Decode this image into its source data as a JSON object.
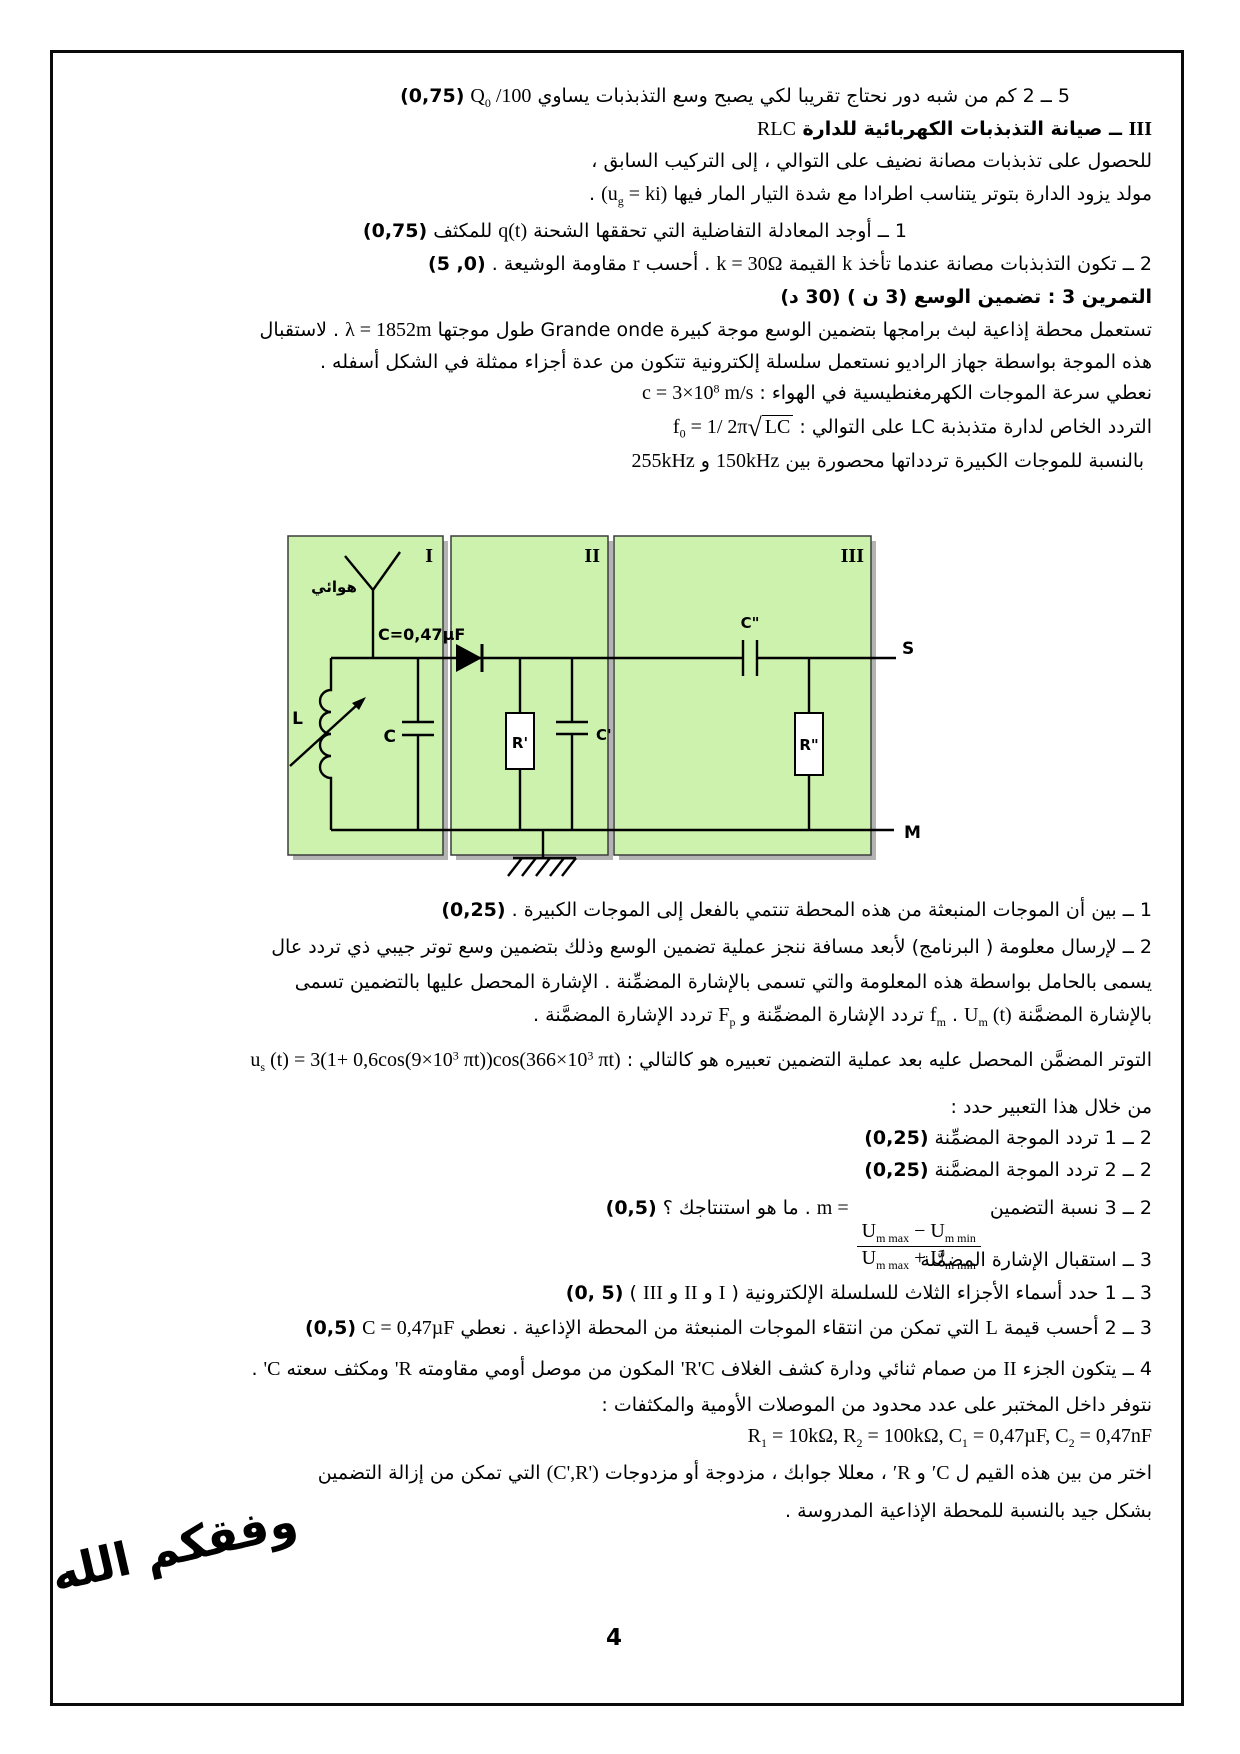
{
  "footer": {
    "dua": "وفقكم الله",
    "page_number": "4"
  },
  "colors": {
    "box_fill": "#ccf2ad",
    "box_stroke": "#3c3c3c",
    "box_shadow": "#b3b3b3",
    "ink": "#000000"
  },
  "diagram": {
    "box_labels": {
      "i": "I",
      "ii": "II",
      "iii": "III"
    },
    "antenna_label": "هوائي",
    "cap_value_label": "C=0,47µF",
    "inductor_label": "L",
    "cap_label": "C",
    "r_prime_label": "R'",
    "c_prime_label": "C'",
    "c_dprime_label": "C\"",
    "r_dprime_label": "R\"",
    "terminal_s": "S",
    "terminal_m": "M"
  },
  "lines": [
    {
      "top": 84,
      "r": 170,
      "segs": [
        {
          "k": "a",
          "t": "5 ــ 2 كم من شبه دور نحتاج تقريبا لكي يصبح وسع التذبذبات يساوي "
        },
        {
          "k": "f",
          "segs": [
            {
              "k": "m",
              "t": "Q"
            },
            {
              "k": "sub",
              "t": "0"
            },
            {
              "k": "m",
              "t": " /100"
            }
          ]
        },
        {
          "k": "a",
          "t": "  "
        },
        {
          "k": "b",
          "t": "(0,75)"
        }
      ]
    },
    {
      "top": 117,
      "r": 88,
      "segs": [
        {
          "k": "mb",
          "t": "III"
        },
        {
          "k": "ab",
          "t": " ــ صيانة التذبذبات الكهربائية للدارة "
        },
        {
          "k": "m",
          "t": "RLC"
        }
      ]
    },
    {
      "top": 150,
      "r": 88,
      "segs": [
        {
          "k": "a",
          "t": "للحصول على تذبذبات مصانة نضيف على التوالي ، إلى التركيب السابق ،"
        }
      ]
    },
    {
      "top": 182,
      "r": 88,
      "segs": [
        {
          "k": "a",
          "t": "مولد يزود الدارة بتوتر يتناسب اطرادا مع شدة التيار المار فيها "
        },
        {
          "k": "f",
          "segs": [
            {
              "k": "m",
              "t": "(u"
            },
            {
              "k": "sub",
              "t": "g"
            },
            {
              "k": "m",
              "t": " = ki)"
            }
          ]
        },
        {
          "k": "a",
          "t": " ."
        }
      ]
    },
    {
      "top": 219,
      "r": 333,
      "segs": [
        {
          "k": "a",
          "t": "1 ــ أوجد المعادلة التفاضلية التي تحققها الشحنة "
        },
        {
          "k": "f",
          "segs": [
            {
              "k": "m",
              "t": "q(t)"
            }
          ]
        },
        {
          "k": "a",
          "t": " للمكثف "
        },
        {
          "k": "b",
          "t": "(0,75)"
        }
      ]
    },
    {
      "top": 252,
      "r": 88,
      "segs": [
        {
          "k": "a",
          "t": "2 ــ تكون التذبذبات مصانة عندما تأخذ "
        },
        {
          "k": "m",
          "t": "k"
        },
        {
          "k": "a",
          "t": " القيمة "
        },
        {
          "k": "f",
          "segs": [
            {
              "k": "m",
              "t": "k = 30Ω"
            }
          ]
        },
        {
          "k": "a",
          "t": " . أحسب "
        },
        {
          "k": "m",
          "t": "r"
        },
        {
          "k": "a",
          "t": " مقاومة الوشيعة . "
        },
        {
          "k": "b",
          "t": "(0, 5)"
        }
      ]
    },
    {
      "top": 286,
      "r": 88,
      "segs": [
        {
          "k": "ab",
          "t": "التمرين 3 : تضمين الوسع (3 ن )  (30 د)"
        }
      ]
    },
    {
      "top": 318,
      "r": 88,
      "segs": [
        {
          "k": "a",
          "t": "تستعمل محطة إذاعية لبث برامجها بتضمين الوسع موجة كبيرة "
        },
        {
          "k": "a",
          "t": "Grande onde"
        },
        {
          "k": "a",
          "t": " طول موجتها "
        },
        {
          "k": "f",
          "segs": [
            {
              "k": "m",
              "t": "λ = 1852m"
            }
          ]
        },
        {
          "k": "a",
          "t": " . لاستقبال"
        }
      ]
    },
    {
      "top": 351,
      "r": 88,
      "segs": [
        {
          "k": "a",
          "t": "هذه الموجة بواسطة جهاز الراديو نستعمل سلسلة إلكترونية تتكون من عدة أجزاء ممثلة في الشكل أسفله ."
        }
      ]
    },
    {
      "top": 381,
      "r": 88,
      "segs": [
        {
          "k": "a",
          "t": "نعطي سرعة الموجات الكهرمغنطيسية في الهواء :  "
        },
        {
          "k": "f",
          "segs": [
            {
              "k": "m",
              "t": "c = 3×10"
            },
            {
              "k": "sup",
              "t": "8"
            },
            {
              "k": "m",
              "t": " m/s"
            }
          ]
        }
      ]
    },
    {
      "top": 412,
      "r": 88,
      "segs": [
        {
          "k": "a",
          "t": "التردد الخاص لدارة متذبذبة "
        },
        {
          "k": "a",
          "t": "LC"
        },
        {
          "k": "a",
          "t": " على التوالي :  "
        },
        {
          "k": "f",
          "segs": [
            {
              "k": "m",
              "t": "f"
            },
            {
              "k": "sub",
              "t": "0"
            },
            {
              "k": "m",
              "t": " = 1/ 2π"
            },
            {
              "k": "sqrt",
              "segs": [
                {
                  "k": "m",
                  "t": "LC"
                }
              ]
            }
          ]
        }
      ]
    },
    {
      "top": 449,
      "r": 96,
      "segs": [
        {
          "k": "a",
          "t": "بالنسبة للموجات الكبيرة تردداتها محصورة بين  "
        },
        {
          "k": "m",
          "t": "150kHz"
        },
        {
          "k": "a",
          "t": " و "
        },
        {
          "k": "m",
          "t": "255kHz"
        }
      ]
    },
    {
      "top": 899,
      "r": 88,
      "segs": [
        {
          "k": "a",
          "t": "1 ــ بين أن الموجات المنبعثة من هذه المحطة تنتمي بالفعل إلى الموجات الكبيرة . "
        },
        {
          "k": "b",
          "t": "(0,25)"
        }
      ]
    },
    {
      "top": 936,
      "r": 88,
      "segs": [
        {
          "k": "a",
          "t": "2 ــ لإرسال معلومة ( البرنامج) لأبعد مسافة ننجز عملية تضمين الوسع وذلك بتضمين وسع توتر جيبي ذي تردد عال"
        }
      ]
    },
    {
      "top": 971,
      "r": 88,
      "segs": [
        {
          "k": "a",
          "t": "يسمى بالحامل بواسطة هذه المعلومة والتي تسمى بالإشارة المضمِّنة . الإشارة المحصل عليها بالتضمين تسمى"
        }
      ]
    },
    {
      "top": 1003,
      "r": 88,
      "segs": [
        {
          "k": "a",
          "t": "بالإشارة المضمَّنة "
        },
        {
          "k": "f",
          "segs": [
            {
              "k": "m",
              "t": "U"
            },
            {
              "k": "sub",
              "t": "m"
            },
            {
              "k": "m",
              "t": " (t)"
            }
          ]
        },
        {
          "k": "a",
          "t": " . "
        },
        {
          "k": "f",
          "segs": [
            {
              "k": "m",
              "t": "f"
            },
            {
              "k": "sub",
              "t": "m"
            }
          ]
        },
        {
          "k": "a",
          "t": " تردد الإشارة المضمِّنة و "
        },
        {
          "k": "f",
          "segs": [
            {
              "k": "m",
              "t": "F"
            },
            {
              "k": "sub",
              "t": "p"
            }
          ]
        },
        {
          "k": "a",
          "t": " تردد الإشارة المضمَّنة ."
        }
      ]
    },
    {
      "top": 1048,
      "r": 88,
      "segs": [
        {
          "k": "a",
          "t": "التوتر المضمَّن المحصل عليه بعد عملية التضمين تعبيره هو كالتالي :  "
        },
        {
          "k": "f",
          "segs": [
            {
              "k": "m",
              "t": "u"
            },
            {
              "k": "sub",
              "t": "s"
            },
            {
              "k": "m",
              "t": " (t) = 3(1+ 0,6cos(9×10"
            },
            {
              "k": "sup",
              "t": "3"
            },
            {
              "k": "m",
              "t": " πt))cos(366×10"
            },
            {
              "k": "sup",
              "t": "3"
            },
            {
              "k": "m",
              "t": " πt)"
            }
          ]
        }
      ]
    },
    {
      "top": 1096,
      "r": 88,
      "segs": [
        {
          "k": "a",
          "t": "من خلال هذا التعبير حدد :"
        }
      ]
    },
    {
      "top": 1127,
      "r": 88,
      "segs": [
        {
          "k": "a",
          "t": "2 ــ 1 تردد الموجة المضمِّنة "
        },
        {
          "k": "b",
          "t": "(0,25)"
        }
      ]
    },
    {
      "top": 1159,
      "r": 88,
      "segs": [
        {
          "k": "a",
          "t": "2 ــ 2 تردد الموجة المضمَّنة "
        },
        {
          "k": "b",
          "t": "(0,25)"
        }
      ]
    },
    {
      "top": 1196,
      "r": 88,
      "segs": [
        {
          "k": "a",
          "t": "2 ــ 3 نسبة التضمين  "
        },
        {
          "k": "f",
          "segs": [
            {
              "k": "m",
              "t": "m = "
            },
            {
              "k": "frac",
              "num": [
                {
                  "k": "m",
                  "t": "U"
                },
                {
                  "k": "sub",
                  "t": "m max"
                },
                {
                  "k": "m",
                  "t": " − U"
                },
                {
                  "k": "sub",
                  "t": "m min"
                }
              ],
              "den": [
                {
                  "k": "m",
                  "t": "U"
                },
                {
                  "k": "sub",
                  "t": "m max"
                },
                {
                  "k": "m",
                  "t": " + U"
                },
                {
                  "k": "sub",
                  "t": "m min"
                }
              ]
            }
          ]
        },
        {
          "k": "a",
          "t": " . ما هو استنتاجك ؟ "
        },
        {
          "k": "b",
          "t": "(0,5)"
        }
      ]
    },
    {
      "top": 1249,
      "r": 88,
      "segs": [
        {
          "k": "a",
          "t": "3 ــ استقبال الإشارة المضمَّنة"
        }
      ]
    },
    {
      "top": 1281,
      "r": 88,
      "segs": [
        {
          "k": "a",
          "t": "3 ــ 1 حدد أسماء الأجزاء الثلاث للسلسلة الإلكترونية ( "
        },
        {
          "k": "m",
          "t": "I"
        },
        {
          "k": "a",
          "t": " و "
        },
        {
          "k": "m",
          "t": "II"
        },
        {
          "k": "a",
          "t": " و "
        },
        {
          "k": "m",
          "t": "III"
        },
        {
          "k": "a",
          "t": " ) "
        },
        {
          "k": "b",
          "t": "(0, 5)"
        }
      ]
    },
    {
      "top": 1316,
      "r": 88,
      "segs": [
        {
          "k": "a",
          "t": "3 ــ 2 أحسب قيمة "
        },
        {
          "k": "m",
          "t": "L"
        },
        {
          "k": "a",
          "t": " التي تمكن من انتقاء الموجات المنبعثة من المحطة الإذاعية . نعطي "
        },
        {
          "k": "f",
          "segs": [
            {
              "k": "m",
              "t": "C = 0,47µF"
            }
          ]
        },
        {
          "k": "a",
          "t": "  "
        },
        {
          "k": "b",
          "t": "(0,5)"
        }
      ]
    },
    {
      "top": 1357,
      "r": 88,
      "segs": [
        {
          "k": "a",
          "t": "4 ــ يتكون الجزء "
        },
        {
          "k": "m",
          "t": "II"
        },
        {
          "k": "a",
          "t": " من صمام ثنائي ودارة كشف الغلاف "
        },
        {
          "k": "m",
          "t": "R'C'"
        },
        {
          "k": "a",
          "t": " المكون من موصل أومي مقاومته "
        },
        {
          "k": "m",
          "t": "R'"
        },
        {
          "k": "a",
          "t": " ومكثف سعته "
        },
        {
          "k": "m",
          "t": "C'"
        },
        {
          "k": "a",
          "t": " ."
        }
      ]
    },
    {
      "top": 1394,
      "r": 88,
      "segs": [
        {
          "k": "a",
          "t": "نتوفر داخل المختبر على عدد محدود من الموصلات الأومية والمكثفات :"
        }
      ]
    },
    {
      "top": 1424,
      "r": 88,
      "segs": [
        {
          "k": "f",
          "segs": [
            {
              "k": "m",
              "t": "R"
            },
            {
              "k": "sub",
              "t": "1"
            },
            {
              "k": "m",
              "t": " = 10kΩ, R"
            },
            {
              "k": "sub",
              "t": "2"
            },
            {
              "k": "m",
              "t": " = 100kΩ, C"
            },
            {
              "k": "sub",
              "t": "1"
            },
            {
              "k": "m",
              "t": " = 0,47µF, C"
            },
            {
              "k": "sub",
              "t": "2"
            },
            {
              "k": "m",
              "t": " = 0,47nF"
            }
          ]
        }
      ]
    },
    {
      "top": 1461,
      "r": 88,
      "segs": [
        {
          "k": "a",
          "t": "اختر من بين هذه القيم ل "
        },
        {
          "k": "m",
          "t": "C′"
        },
        {
          "k": "a",
          "t": " و "
        },
        {
          "k": "m",
          "t": "R′"
        },
        {
          "k": "a",
          "t": " ، معللا جوابك ، مزدوجة أو مزدوجات "
        },
        {
          "k": "f",
          "segs": [
            {
              "k": "m",
              "t": "(C',R')"
            }
          ]
        },
        {
          "k": "a",
          "t": " التي تمكن من إزالة التضمين"
        }
      ]
    },
    {
      "top": 1500,
      "r": 88,
      "segs": [
        {
          "k": "a",
          "t": "بشكل جيد بالنسبة للمحطة الإذاعية المدروسة ."
        }
      ]
    }
  ]
}
